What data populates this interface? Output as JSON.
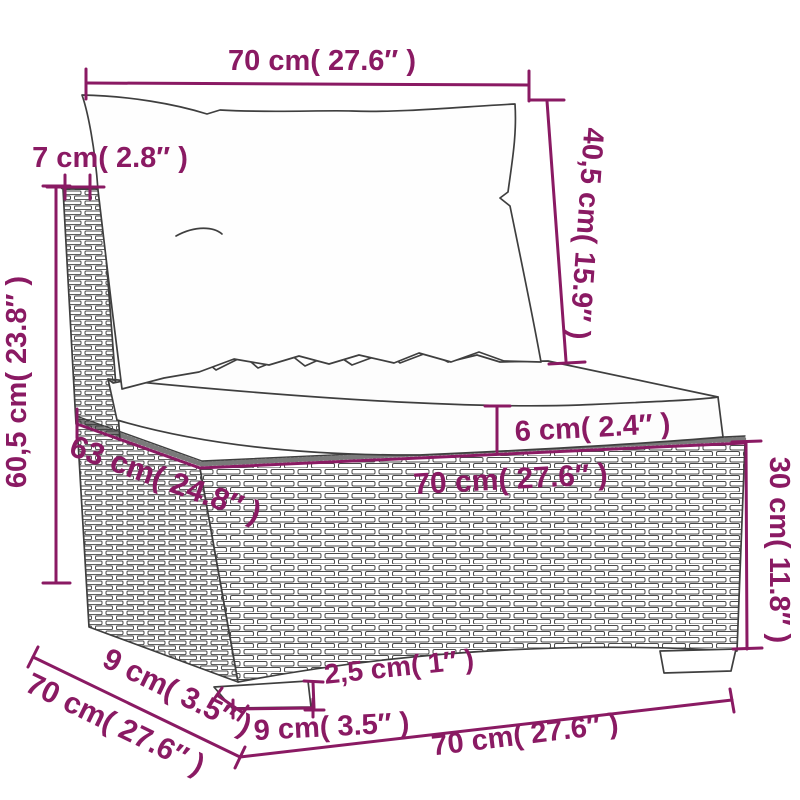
{
  "diagram": {
    "type": "product-dimension-diagram",
    "product": "poly rattan middle sofa section with cushions",
    "units": "cm (in)"
  },
  "colors": {
    "dimension_accent": "#8a1a63",
    "line_art": "#3f3f3f",
    "background": "#ffffff"
  },
  "labels": {
    "top_width": "70 cm( 27.6″ )",
    "back_frame_depth": "7 cm( 2.8″ )",
    "back_cushion_height": "40,5 cm( 15.9″ )",
    "overall_height": "60,5 cm( 23.8″ )",
    "seat_cushion_thickness": "6 cm( 2.4″ )",
    "seat_depth": "63 cm( 24.8″ )",
    "seat_width": "70 cm( 27.6″ )",
    "base_height": "30 cm( 11.8″ )",
    "overall_depth": "70 cm( 27.6″ )",
    "foot_depth": "9 cm( 3.5″ )",
    "foot_width": "9 cm( 3.5″ )",
    "foot_height": "2,5 cm( 1″ )",
    "base_width_bottom": "70 cm( 27.6″ )"
  },
  "measurements": {
    "top_width_cm": 70,
    "back_frame_depth_cm": 7,
    "back_cushion_height_cm": 40.5,
    "overall_height_cm": 60.5,
    "seat_cushion_thickness_cm": 6,
    "seat_depth_cm": 63,
    "seat_width_cm": 70,
    "base_height_cm": 30,
    "overall_depth_cm": 70,
    "foot_depth_cm": 9,
    "foot_width_cm": 9,
    "foot_height_cm": 2.5,
    "base_width_cm": 70
  }
}
